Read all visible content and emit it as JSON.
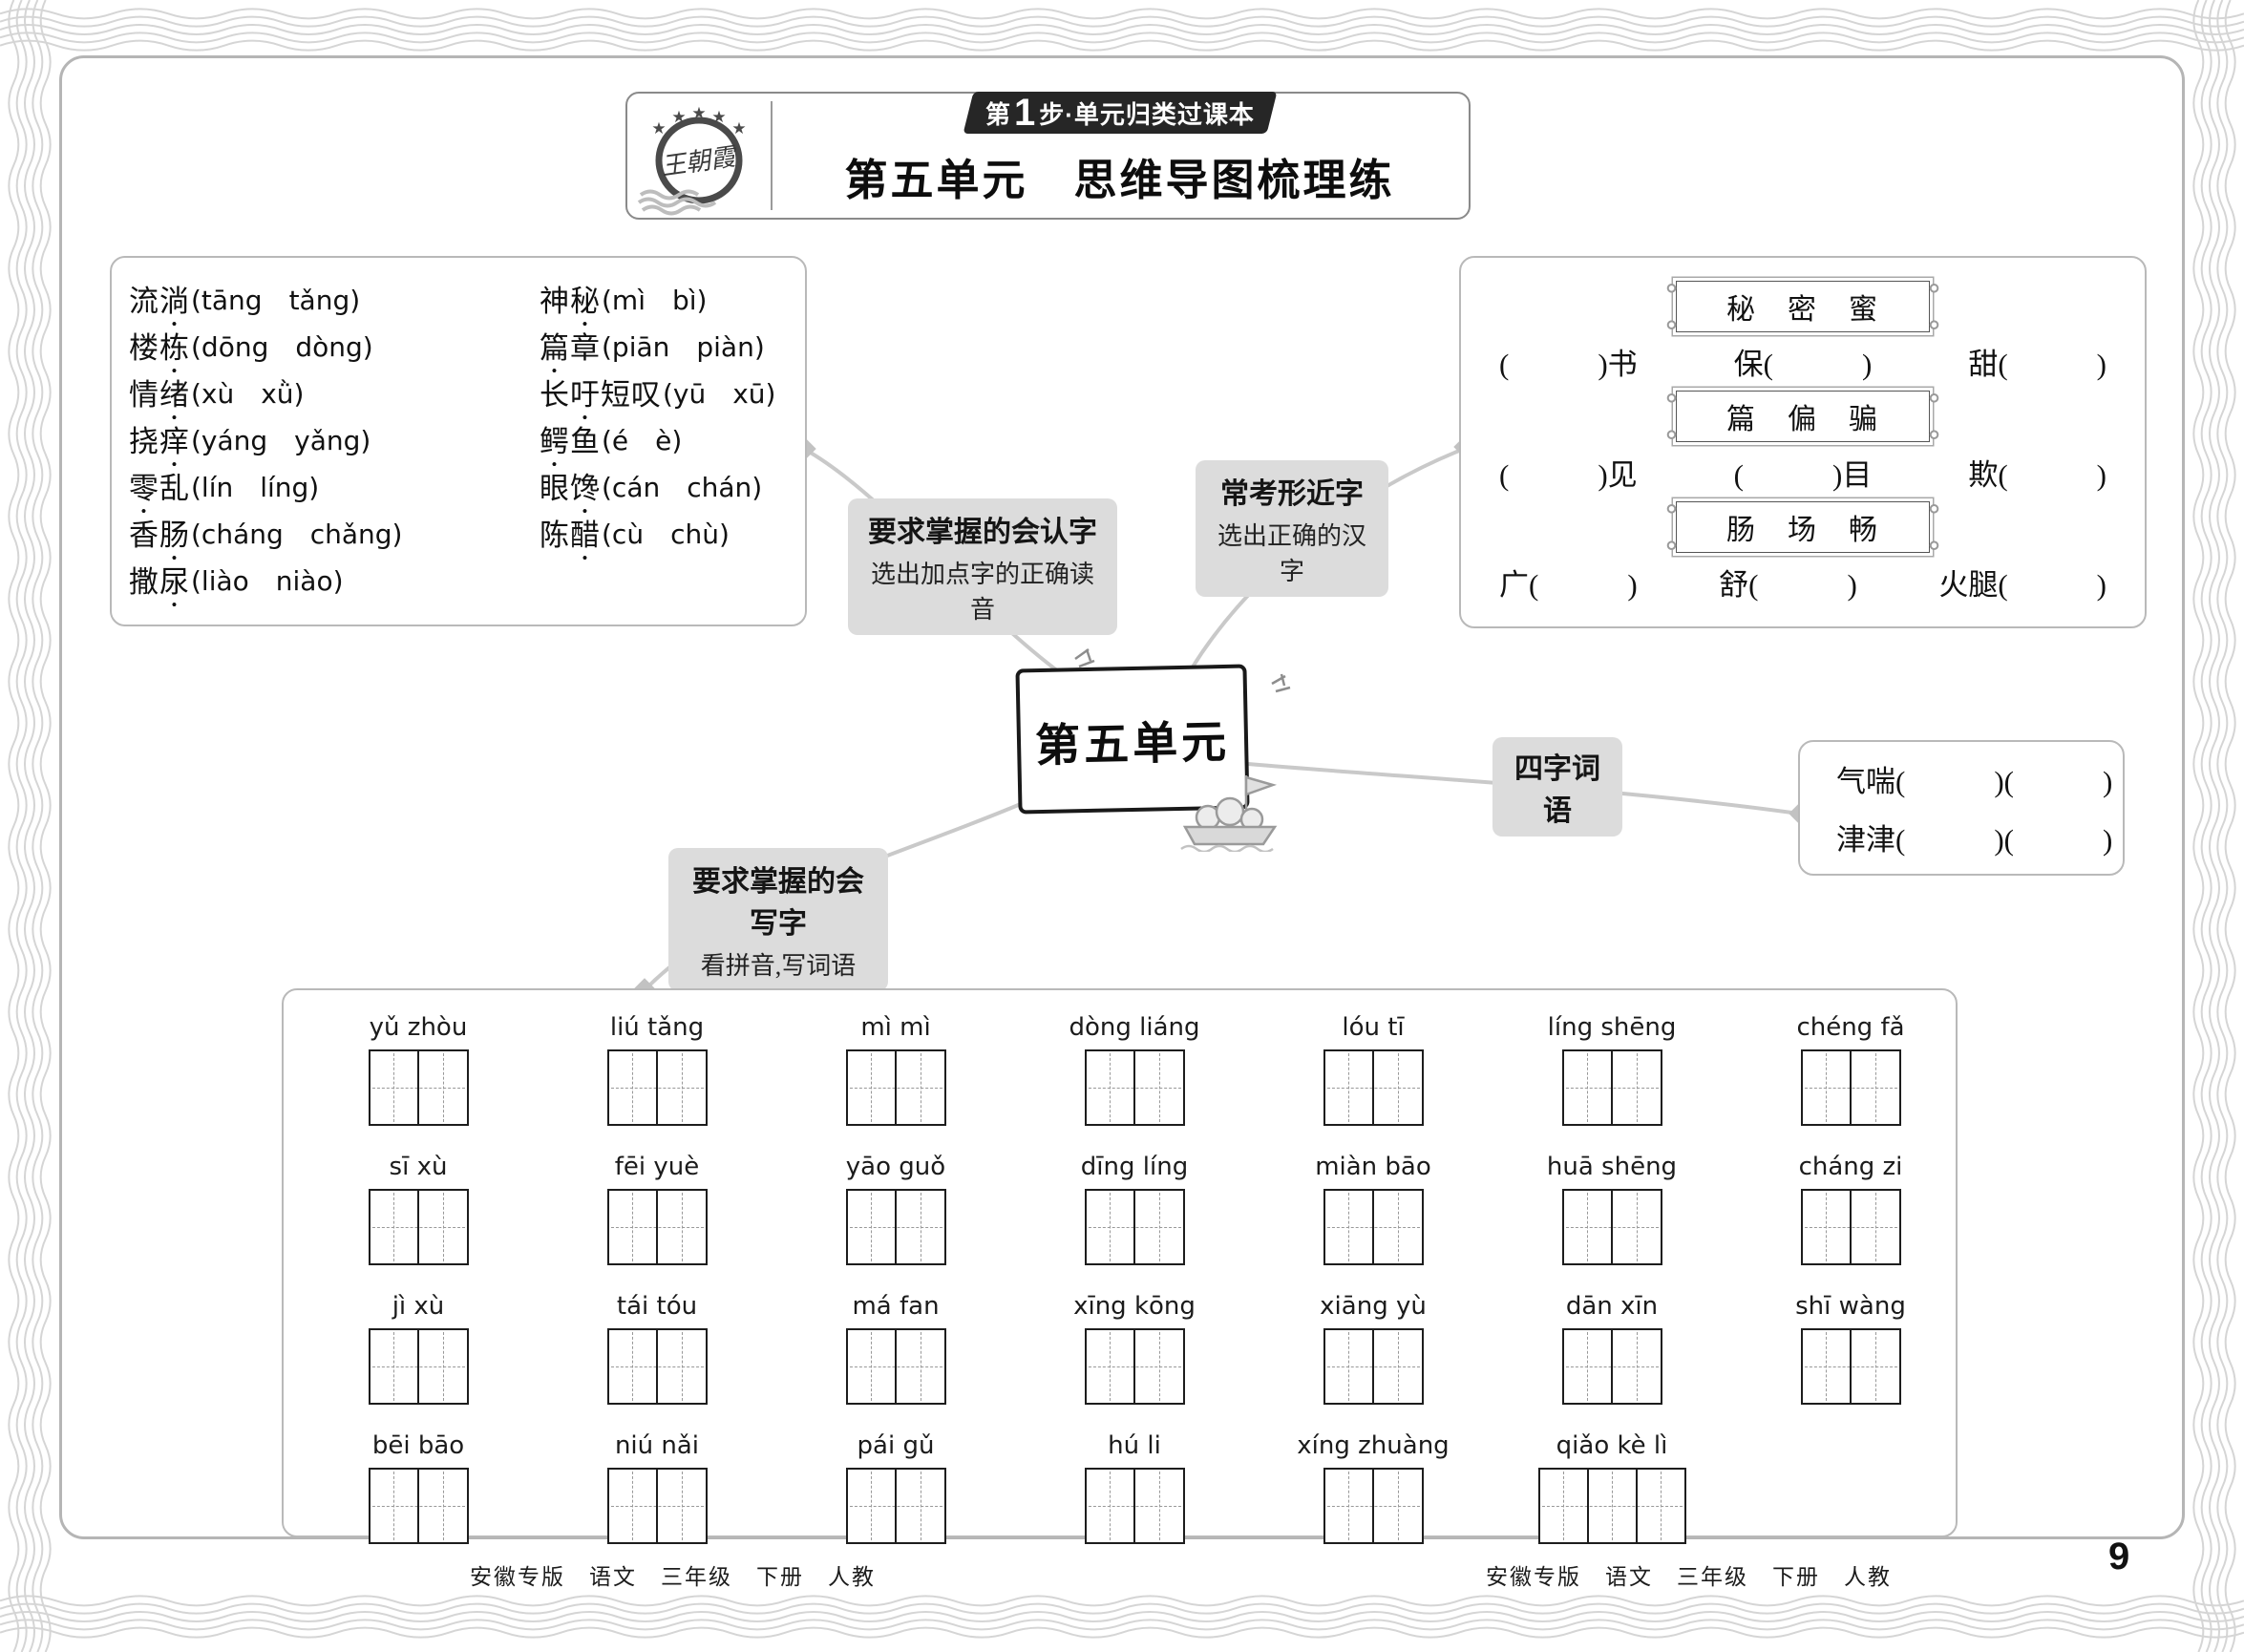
{
  "colors": {
    "badge_bg": "#262626",
    "label_bg": "#dcdcdc",
    "connector_line": "#c9c9c9",
    "frame_wave": "#d5d5d5",
    "box_border": "#b9b9b9"
  },
  "header": {
    "logo_text": "王朝霞",
    "badge": {
      "step_label": "第",
      "step_num": "1",
      "rest": "步·单元归类过课本"
    },
    "title": "第五单元　思维导图梳理练"
  },
  "mindmap": {
    "center": "第五单元",
    "renzi": {
      "title": "要求掌握的会认字",
      "sub": "选出加点字的正确读音"
    },
    "xingjinzi": {
      "title": "常考形近字",
      "sub": "选出正确的汉字"
    },
    "sizi": {
      "title": "四字词语"
    },
    "xiezi": {
      "title": "要求掌握的会写字",
      "sub": "看拼音,写词语"
    }
  },
  "recognize": {
    "left": [
      {
        "pre": "流",
        "dot": "淌",
        "post": "",
        "options": "(tāng　tǎng)"
      },
      {
        "pre": "楼",
        "dot": "栋",
        "post": "",
        "options": "(dōng　dòng)"
      },
      {
        "pre": "情",
        "dot": "绪",
        "post": "",
        "options": "(xù　xǜ)"
      },
      {
        "pre": "挠",
        "dot": "痒",
        "post": "",
        "options": "(yáng　yǎng)"
      },
      {
        "pre": "",
        "dot": "零",
        "post": "乱",
        "options": "(lín　líng)"
      },
      {
        "pre": "香",
        "dot": "肠",
        "post": "",
        "options": "(cháng　chǎng)"
      },
      {
        "pre": "撒",
        "dot": "尿",
        "post": "",
        "options": "(liào　niào)"
      }
    ],
    "right": [
      {
        "pre": "神",
        "dot": "秘",
        "post": "",
        "options": "(mì　bì)"
      },
      {
        "pre": "",
        "dot": "篇",
        "post": "章",
        "options": "(piān　piàn)"
      },
      {
        "pre": "长",
        "dot": "吁",
        "post": "短叹",
        "options": "(yū　xū)"
      },
      {
        "pre": "",
        "dot": "鳄",
        "post": "鱼",
        "options": "(é　è)"
      },
      {
        "pre": "眼",
        "dot": "馋",
        "post": "",
        "options": "(cán　chán)"
      },
      {
        "pre": "陈",
        "dot": "醋",
        "post": "",
        "options": "(cù　chù)"
      }
    ]
  },
  "xingjin": {
    "groups": [
      {
        "banner": "秘　密　蜜",
        "slots": [
          "(　　　)书",
          "保(　　　)",
          "甜(　　　)"
        ]
      },
      {
        "banner": "篇　偏　骗",
        "slots": [
          "(　　　)见",
          "(　　　)目",
          "欺(　　　)"
        ]
      },
      {
        "banner": "肠　场　畅",
        "slots": [
          "广(　　　)",
          "舒(　　　)",
          "火腿(　　　)"
        ]
      }
    ]
  },
  "siziwords": [
    {
      "text": "气喘(　　　)(　　　)"
    },
    {
      "text": "津津(　　　)(　　　)"
    }
  ],
  "write": {
    "items": [
      {
        "pinyin": "yǔ  zhòu",
        "cells": "2"
      },
      {
        "pinyin": "liú  tǎng",
        "cells": "2"
      },
      {
        "pinyin": "mì  mì",
        "cells": "2"
      },
      {
        "pinyin": "dòng liáng",
        "cells": "2"
      },
      {
        "pinyin": "lóu  tī",
        "cells": "2"
      },
      {
        "pinyin": "líng shēng",
        "cells": "2"
      },
      {
        "pinyin": "chéng  fǎ",
        "cells": "2"
      },
      {
        "pinyin": "sī  xù",
        "cells": "2"
      },
      {
        "pinyin": "fēi  yuè",
        "cells": "2"
      },
      {
        "pinyin": "yāo  guǒ",
        "cells": "2"
      },
      {
        "pinyin": "dīng  líng",
        "cells": "2"
      },
      {
        "pinyin": "miàn bāo",
        "cells": "2"
      },
      {
        "pinyin": "huā shēng",
        "cells": "2"
      },
      {
        "pinyin": "cháng  zi",
        "cells": "2"
      },
      {
        "pinyin": "jì  xù",
        "cells": "2"
      },
      {
        "pinyin": "tái  tóu",
        "cells": "2"
      },
      {
        "pinyin": "má  fan",
        "cells": "2"
      },
      {
        "pinyin": "xīng kōng",
        "cells": "2"
      },
      {
        "pinyin": "xiāng  yù",
        "cells": "2"
      },
      {
        "pinyin": "dān  xīn",
        "cells": "2"
      },
      {
        "pinyin": "shī  wàng",
        "cells": "2"
      },
      {
        "pinyin": "bēi  bāo",
        "cells": "2"
      },
      {
        "pinyin": "niú  nǎi",
        "cells": "2"
      },
      {
        "pinyin": "pái  gǔ",
        "cells": "2"
      },
      {
        "pinyin": "hú  li",
        "cells": "2"
      },
      {
        "pinyin": "xíng zhuàng",
        "cells": "2"
      },
      {
        "pinyin": "qiǎo  kè  lì",
        "cells": "3"
      }
    ]
  },
  "footer": {
    "text": "安徽专版　语文　三年级　下册　人教",
    "page": "9"
  }
}
